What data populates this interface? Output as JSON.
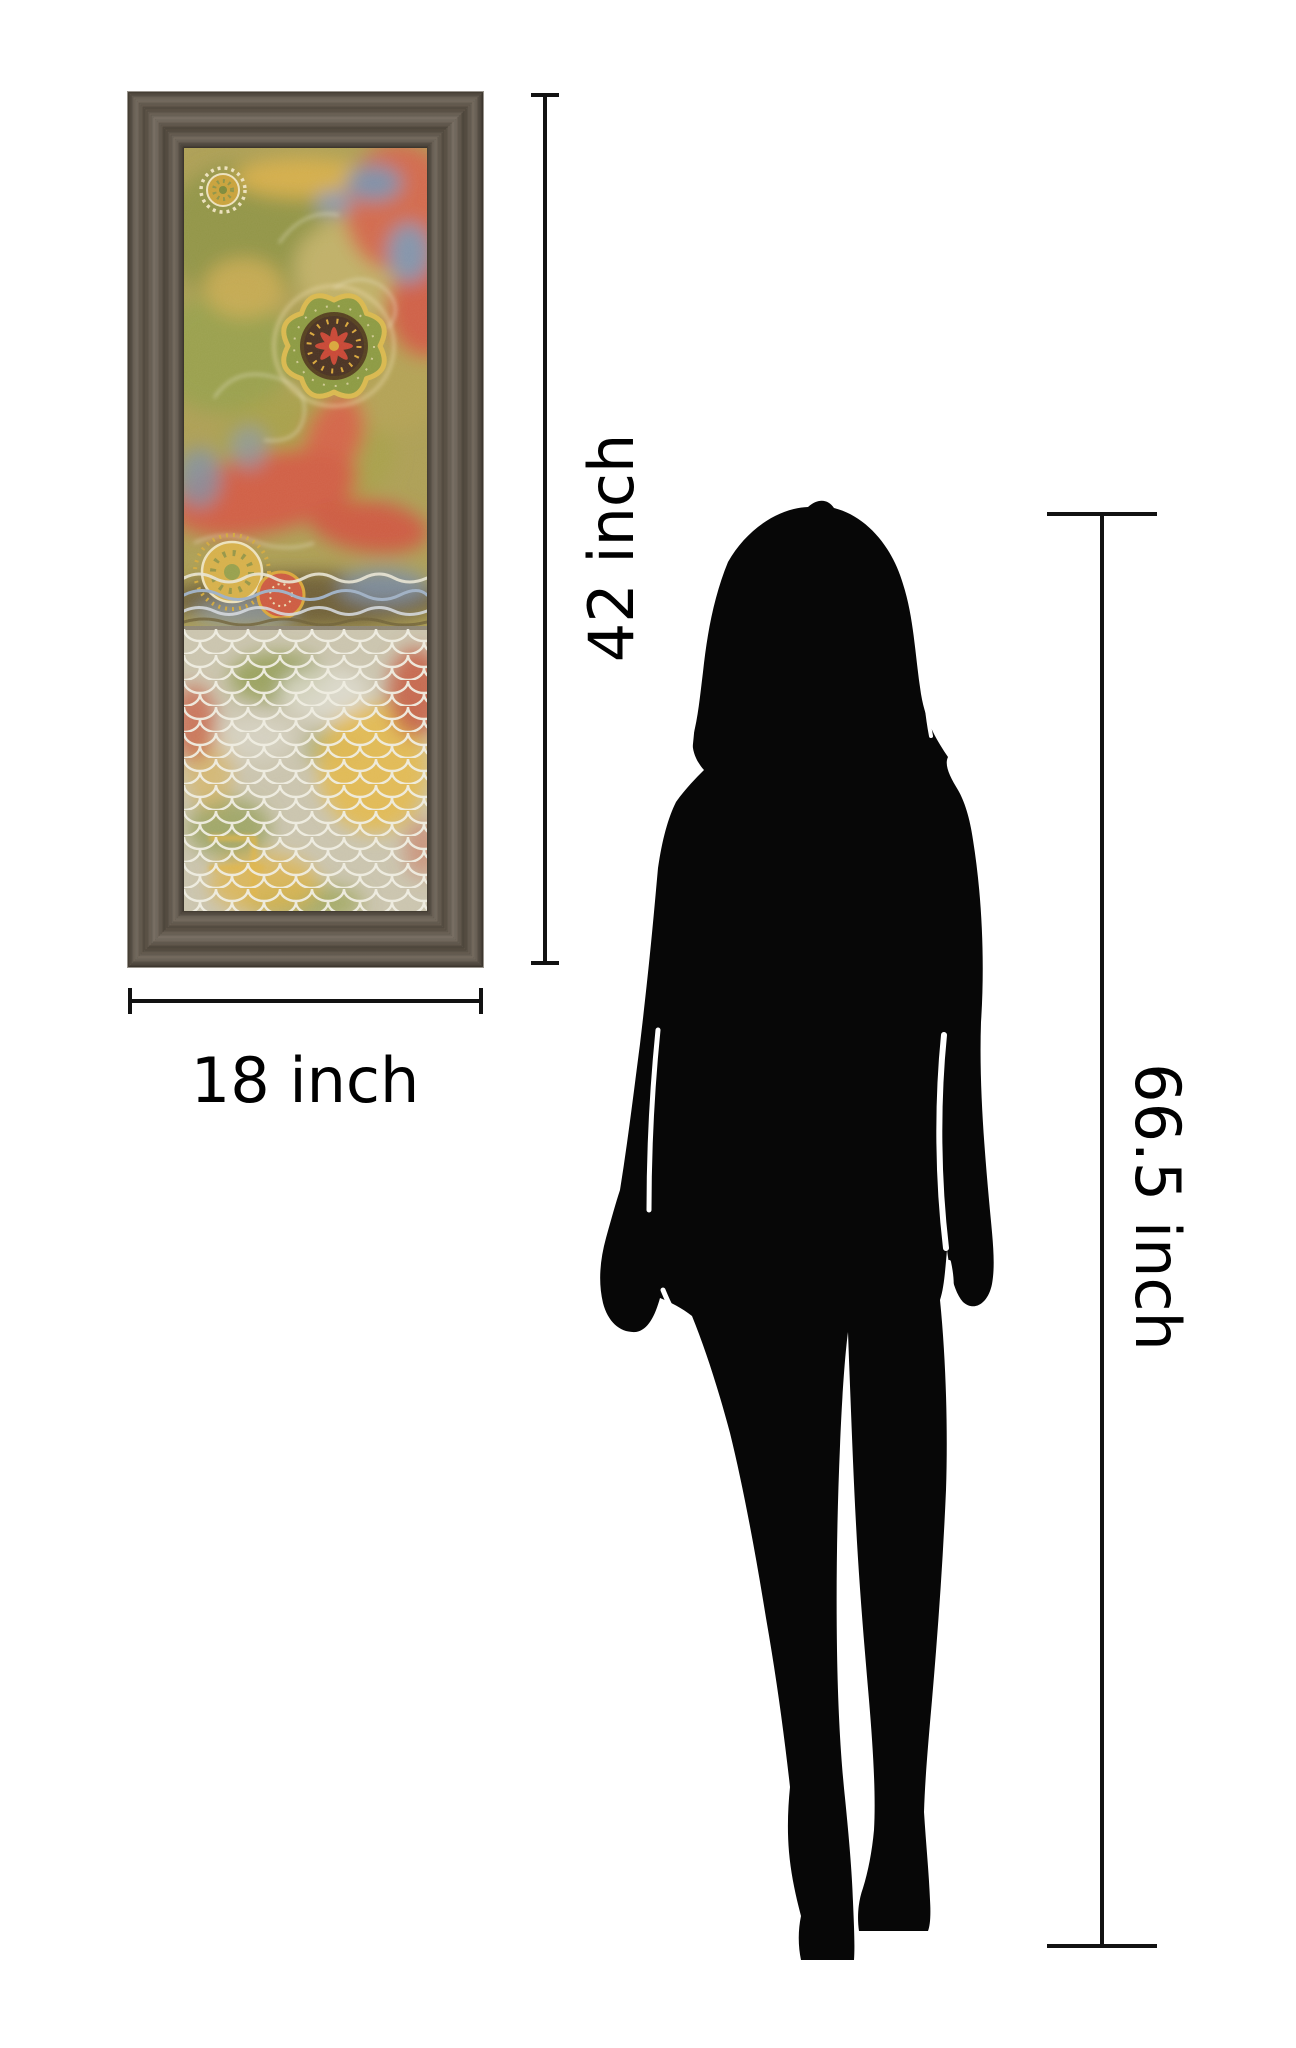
{
  "page": {
    "background_color": "#ffffff"
  },
  "artwork": {
    "kind": "framed abstract floral print",
    "frame_color": "#675d50",
    "palette": {
      "olive_green": "#8f9447",
      "gold": "#d4ae4c",
      "coral_red": "#d05f44",
      "slate_blue": "#7f91a8",
      "cream": "#ece1bd",
      "dark_brown": "#4a3222",
      "lower_canvas": "#cac4ae"
    }
  },
  "person": {
    "kind": "woman silhouette",
    "color": "#070707"
  },
  "dimensions": {
    "line_color": "#121212",
    "text_color": "#000000",
    "artwork_height": {
      "label": "42 inch"
    },
    "artwork_width": {
      "label": "18 inch"
    },
    "person_height": {
      "label": "66.5 inch"
    }
  }
}
